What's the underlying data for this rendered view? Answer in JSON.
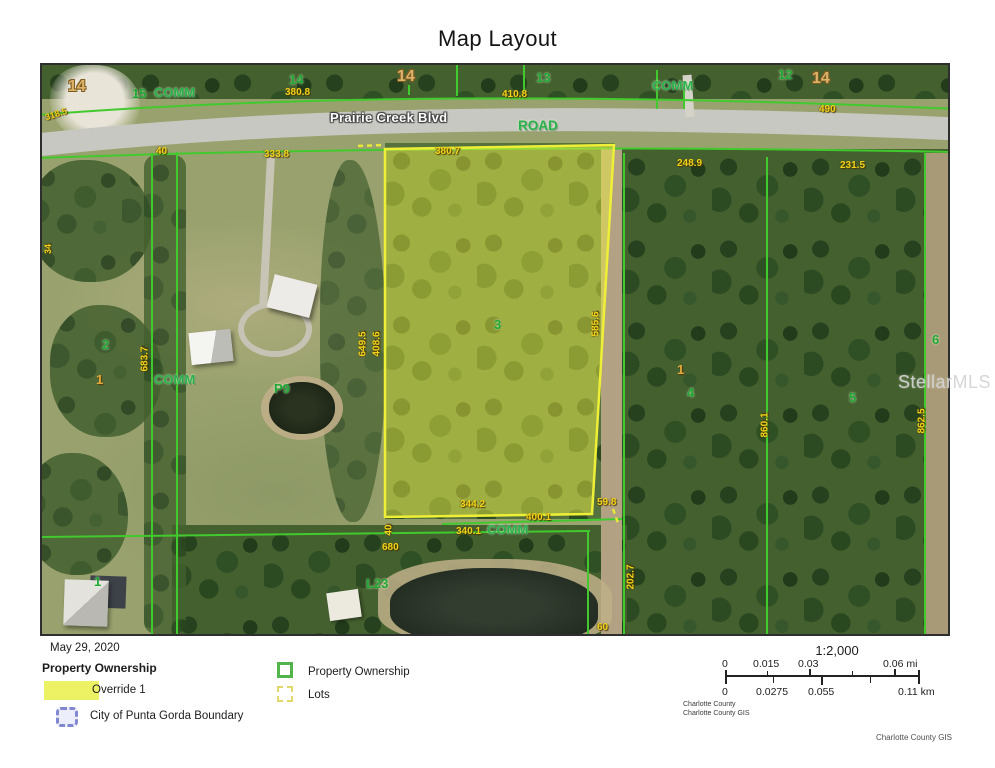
{
  "title": "Map Layout",
  "map": {
    "labels": {
      "sec14_nw": "14",
      "lot15": "15",
      "comm_nw": "COMM",
      "sec14_n1": "14",
      "dim380_8": "380.8",
      "sec14_n2": "14",
      "dim410_8": "410.8",
      "sec13": "13",
      "comm_n": "COMM",
      "sec12": "12",
      "sec14_ne": "14",
      "dim490": "490",
      "dim318_5": "318.5",
      "dim34": "34",
      "road_name": "Prairie Creek Blvd",
      "road": "ROAD",
      "dim40_w": "40",
      "dim333_8": "333.8",
      "dim380_7": "380.7",
      "dim248_9": "248.9",
      "dim231_5": "231.5",
      "lot2": "2",
      "lot1_w": "1",
      "dim683_7": "683.7",
      "comm_w": "COMM",
      "p9": "P9",
      "dim649_5": "649.5",
      "dim408_6": "408.6",
      "lot3": "3",
      "dim585_6": "585.6",
      "lot1_e": "1",
      "lot4": "4",
      "lot5": "5",
      "lot6": "6",
      "dim860_1": "860.1",
      "dim862_5": "862.5",
      "dim344_2": "344.2",
      "dim59_8": "59.8",
      "dim400_1": "400.1",
      "dim340_1": "340.1",
      "comm_s": "COMM",
      "dim40_s": "40",
      "dim680": "680",
      "l23": "L23",
      "dim202_7": "202.7",
      "dim60": "60",
      "lot1_sw": "1"
    },
    "watermark": "StellarMLS"
  },
  "legend": {
    "date": "May 29, 2020",
    "group_title": "Property Ownership",
    "override1": "Override 1",
    "city_boundary": "City of Punta Gorda Boundary",
    "property_ownership": "Property Ownership",
    "lots": "Lots"
  },
  "scalebar": {
    "ratio": "1:2,000",
    "mi": [
      "0",
      "0.015",
      "0.03",
      "0.06 mi"
    ],
    "km": [
      "0",
      "0.0275",
      "0.055",
      "0.11 km"
    ]
  },
  "credits": {
    "line1": "Charlotte County",
    "line2": "Charlotte County GIS",
    "attribution": "Charlotte County GIS"
  },
  "colors": {
    "parcel_line": "#42c92e",
    "highlight_fill": "#ecee46",
    "highlight_outline": "#eef037",
    "dimension_text": "#f2d319",
    "lot_text": "#1fa733",
    "section_text": "#ddb269",
    "city_boundary": "#8187d2"
  }
}
